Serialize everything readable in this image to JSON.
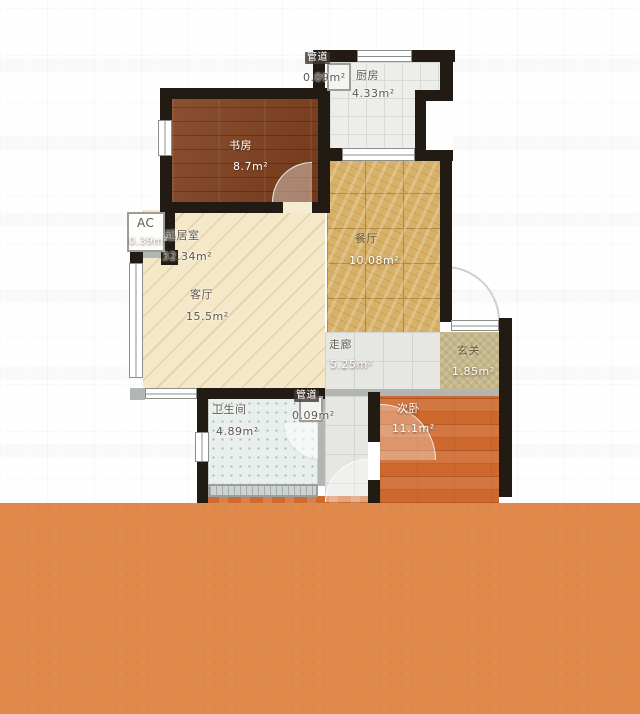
{
  "colors": {
    "wall": "#221b14",
    "floor_study": "#7c3d1b",
    "floor_living": "#f5e8c9",
    "floor_dining": "#d7b168",
    "dining_line": "#b08a41",
    "floor_kitchen": "#edeeeb",
    "kitchen_line": "#d8dad4",
    "floor_corridor": "#e6e7e3",
    "corridor_line": "#d2d4d0",
    "floor_entry": "#c6b88a",
    "floor_bathroom": "#e9efec",
    "bathroom_dot": "#a9bfb5",
    "floor_bedroom": "#ce682c",
    "vanity": "#9aa0a2",
    "thin_wall": "#b2b6b2",
    "window_frame": "#8d8d8a",
    "overlay_orange": "#df8a4b",
    "label_dark": "#5e574b",
    "label_light": "#ffffff"
  },
  "floorplan": {
    "rooms": [
      {
        "id": "duct-top",
        "name": "管道",
        "area_text": "0.09m²"
      },
      {
        "id": "kitchen",
        "name": "厨房",
        "area_text": "4.33m²"
      },
      {
        "id": "study",
        "name": "书房",
        "area_text": "8.7m²"
      },
      {
        "id": "living-total",
        "name": "起居室",
        "area_text": "32.34m²"
      },
      {
        "id": "living",
        "name": "客厅",
        "area_text": "15.5m²"
      },
      {
        "id": "dining",
        "name": "餐厅",
        "area_text": "10.08m²"
      },
      {
        "id": "corridor",
        "name": "走廊",
        "area_text": "5.25m²"
      },
      {
        "id": "entry",
        "name": "玄关",
        "area_text": "1.85m²"
      },
      {
        "id": "bathroom",
        "name": "卫生间",
        "area_text": "4.89m²"
      },
      {
        "id": "duct-bottom",
        "name": "管道",
        "area_text": "0.09m²"
      },
      {
        "id": "bedroom2",
        "name": "次卧",
        "area_text": "11.1m²"
      },
      {
        "id": "ac",
        "name": "AC",
        "area_text": "0.39m²"
      }
    ]
  }
}
